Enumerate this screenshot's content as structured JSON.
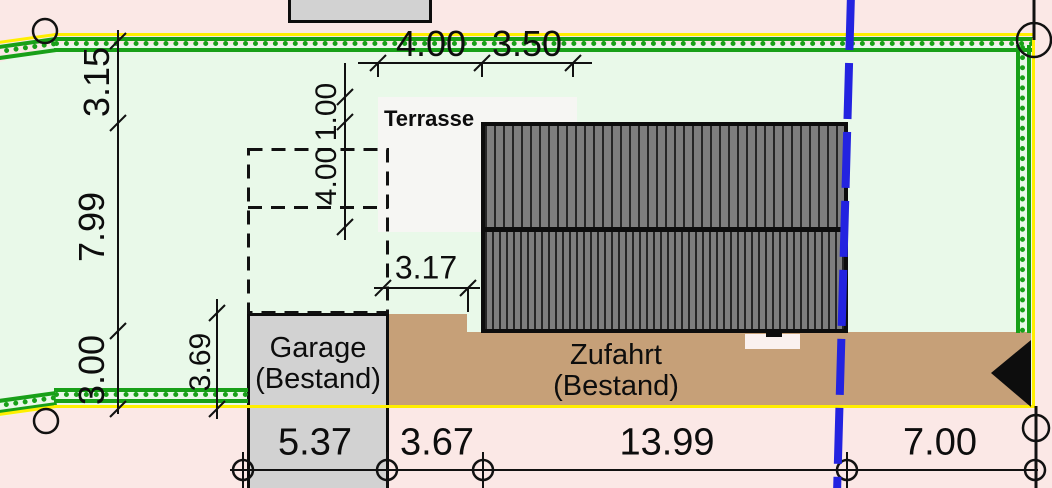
{
  "labels": {
    "terrasse": "Terrasse",
    "garage": [
      "Garage",
      "(Bestand)"
    ],
    "zufahrt": [
      "Zufahrt",
      "(Bestand)"
    ]
  },
  "dimensions": {
    "top": [
      "4.00",
      "3.50"
    ],
    "left_side": [
      "3.15",
      "7.99",
      "3.00"
    ],
    "garage_depth": "3.69",
    "extension_vertical": [
      "1.00",
      "4.00"
    ],
    "gap_house": "3.17",
    "bottom": [
      "5.37",
      "3.67",
      "13.99",
      "7.00"
    ]
  },
  "colors": {
    "boundary_green": "#18a018",
    "boundary_yellow": "#ffef00",
    "parcel_line_blue": "#2323e0",
    "plot_fill": "#e9f9e9",
    "outside_fill": "#fbe8e6",
    "driveway_fill": "#c6a078",
    "building_fill": "#d2d2d2",
    "roof_fill": "#7e7e7e"
  }
}
